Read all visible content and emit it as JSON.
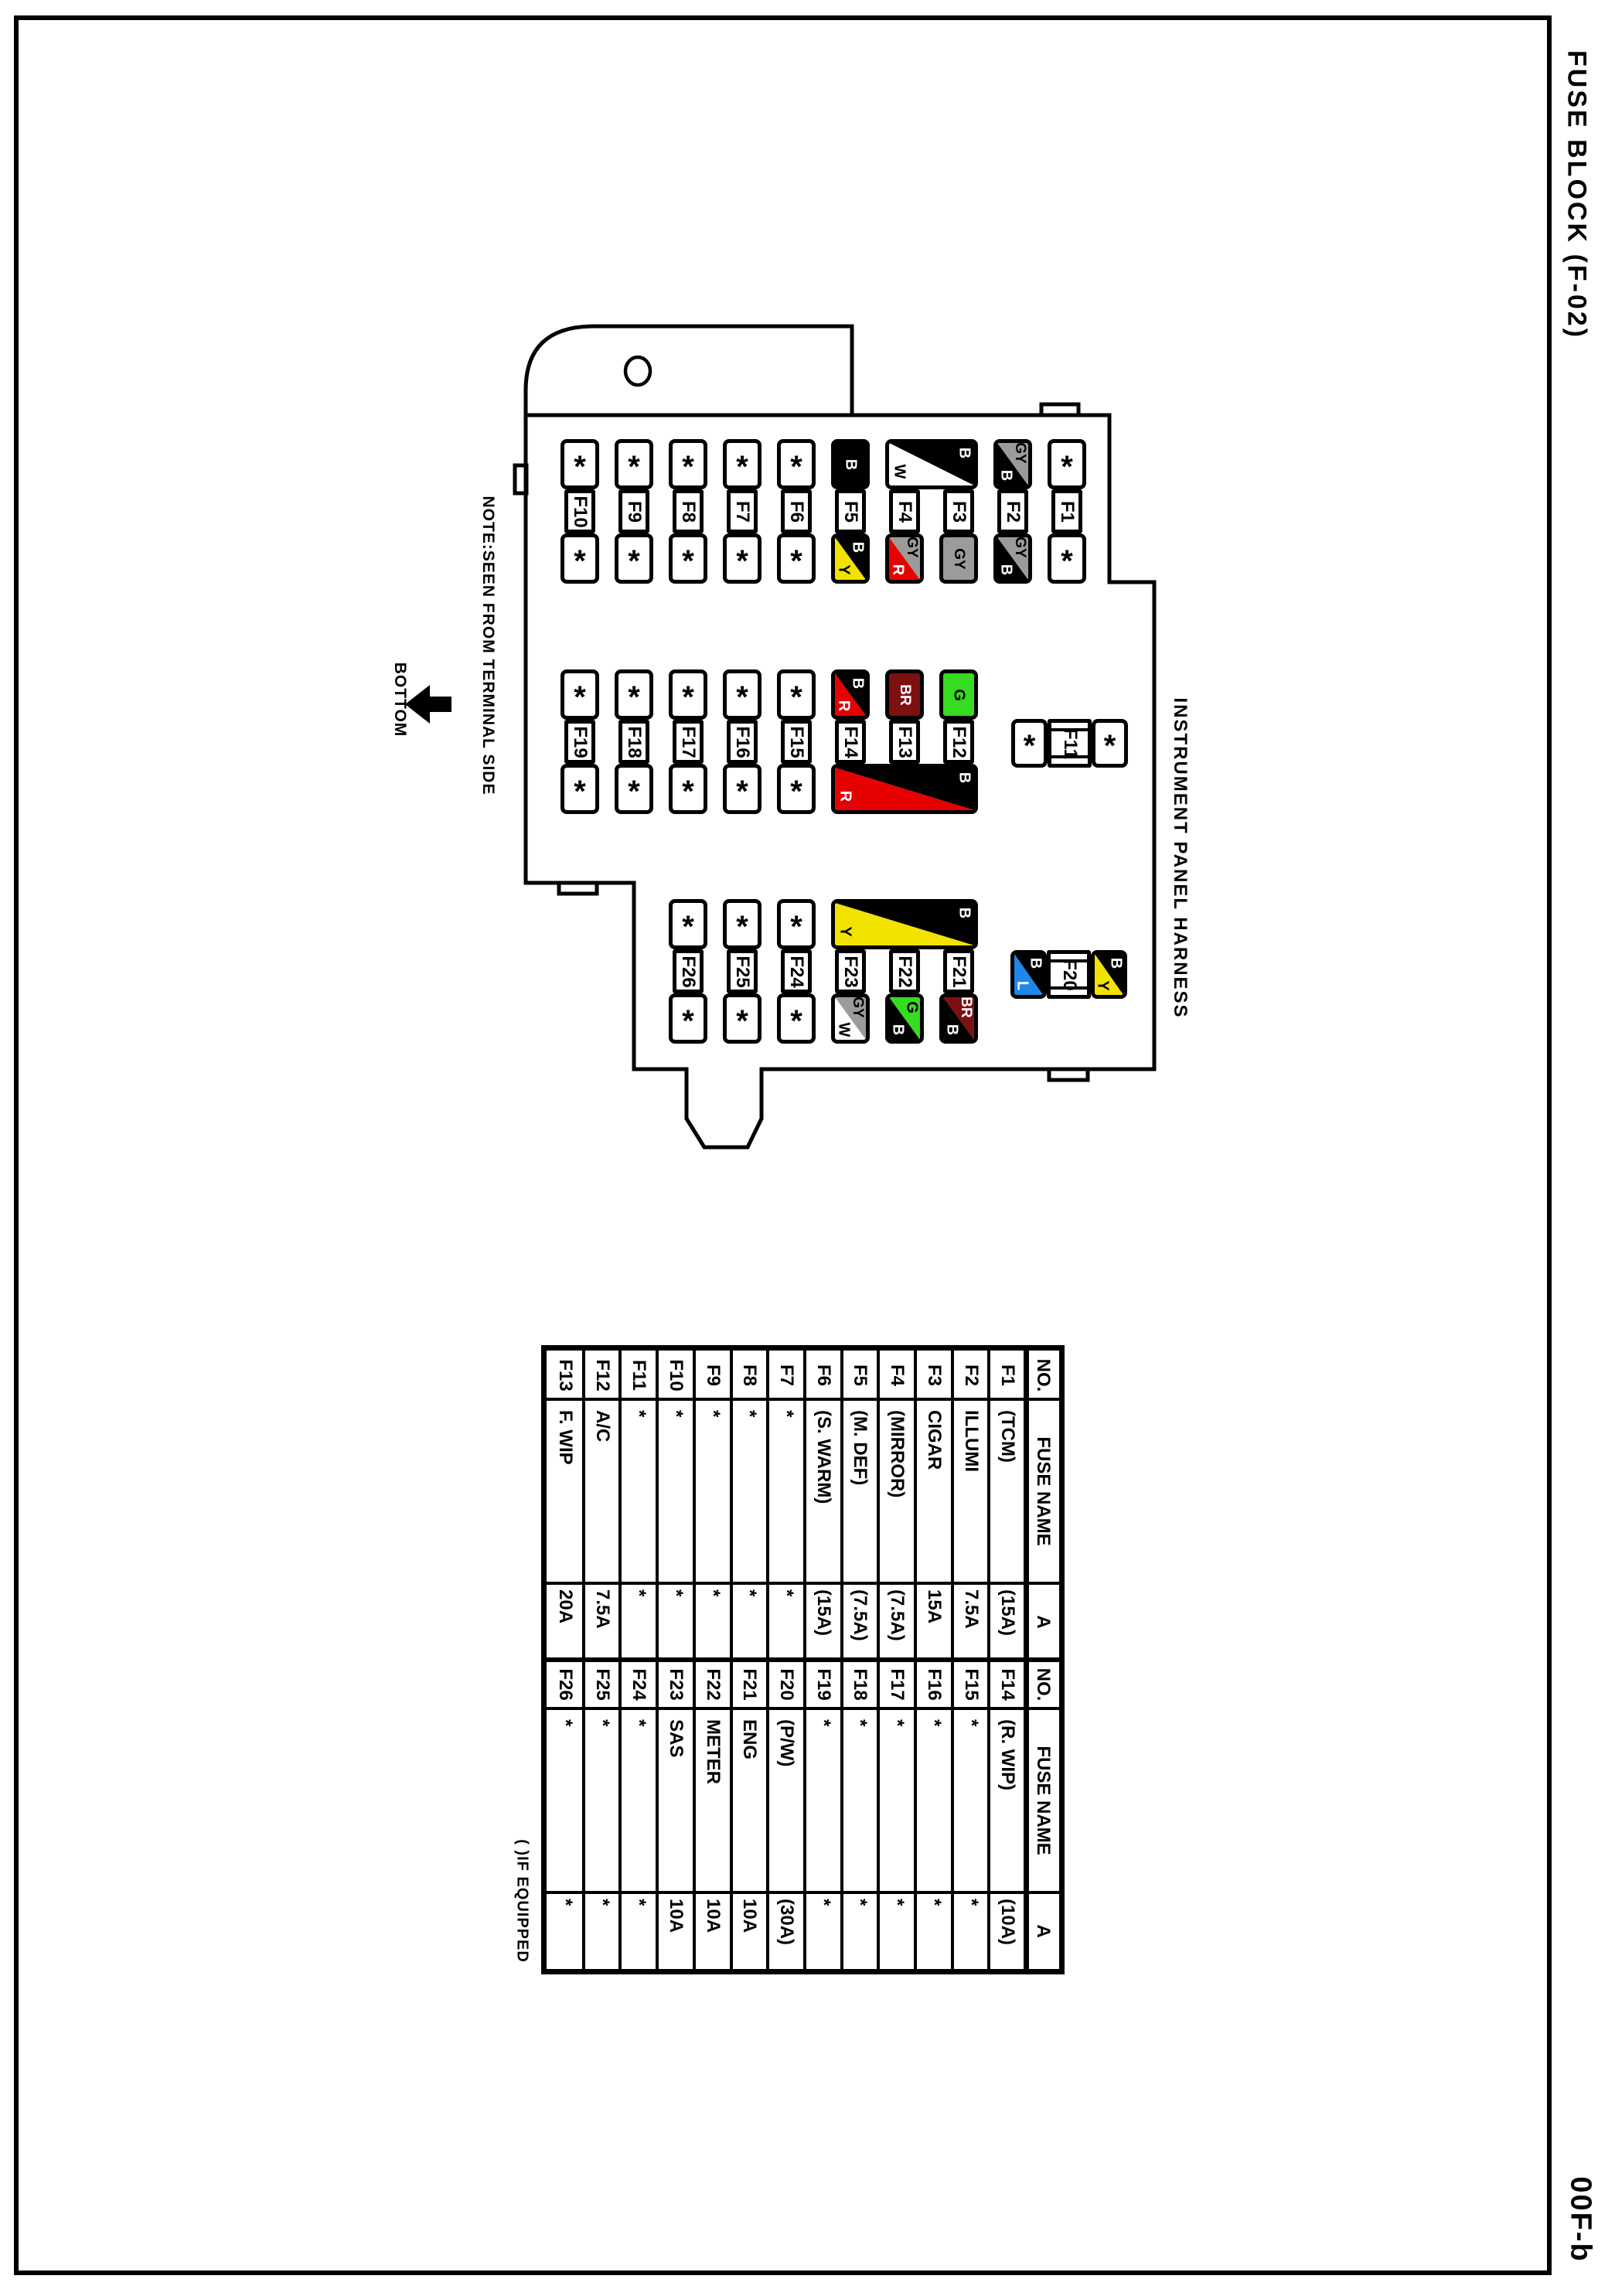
{
  "page": {
    "title": "FUSE BLOCK (F-02)",
    "page_code": "00F-b",
    "note": "NOTE:SEEN FROM TERMINAL SIDE",
    "bottom_label": "BOTTOM",
    "harness_label": "INSTRUMENT PANEL HARNESS",
    "if_equipped_note": "( )IF EQUIPPED"
  },
  "colors": {
    "B": "#000000",
    "W": "#ffffff",
    "GY": "#9b9b9b",
    "R": "#e60000",
    "Y": "#f2e200",
    "G": "#35dc1f",
    "BR": "#7d1011",
    "L": "#1f87e8"
  },
  "fuse_block": {
    "star_symbol": "*",
    "rows": [
      {
        "fuses": [
          {
            "label": "F10",
            "col": 0,
            "top": {
              "star": true
            },
            "bottom": {
              "star": true
            }
          },
          {
            "label": "F9",
            "col": 1,
            "top": {
              "star": true
            },
            "bottom": {
              "star": true
            }
          },
          {
            "label": "F8",
            "col": 2,
            "top": {
              "star": true
            },
            "bottom": {
              "star": true
            }
          },
          {
            "label": "F7",
            "col": 3,
            "top": {
              "star": true
            },
            "bottom": {
              "star": true
            }
          },
          {
            "label": "F6",
            "col": 4,
            "top": {
              "star": true
            },
            "bottom": {
              "star": true
            }
          },
          {
            "label": "F5",
            "col": 5,
            "top": {
              "solid": "B"
            },
            "bottom": {
              "diag": [
                "B",
                "Y"
              ]
            }
          },
          {
            "label": "F4",
            "col": 6,
            "bottom": {
              "diag": [
                "GY",
                "R"
              ]
            }
          },
          {
            "label": "F3",
            "col": 7,
            "bottom": {
              "solid": "GY"
            }
          },
          {
            "label": "F2",
            "col": 8,
            "top": {
              "diag": [
                "GY",
                "B"
              ]
            },
            "bottom": {
              "diag": [
                "GY",
                "B"
              ]
            }
          },
          {
            "label": "F1",
            "col": 9,
            "top": {
              "star": true
            },
            "bottom": {
              "star": true
            }
          }
        ],
        "wide_caps": [
          {
            "band": "top",
            "from_col": 6,
            "to_col": 7,
            "diag": [
              "B",
              "W"
            ]
          }
        ]
      },
      {
        "fuses": [
          {
            "label": "F19",
            "col": 0,
            "top": {
              "star": true
            },
            "bottom": {
              "star": true
            }
          },
          {
            "label": "F18",
            "col": 1,
            "top": {
              "star": true
            },
            "bottom": {
              "star": true
            }
          },
          {
            "label": "F17",
            "col": 2,
            "top": {
              "star": true
            },
            "bottom": {
              "star": true
            }
          },
          {
            "label": "F16",
            "col": 3,
            "top": {
              "star": true
            },
            "bottom": {
              "star": true
            }
          },
          {
            "label": "F15",
            "col": 4,
            "top": {
              "star": true
            },
            "bottom": {
              "star": true
            }
          },
          {
            "label": "F14",
            "col": 5,
            "top": {
              "diag": [
                "B",
                "R"
              ]
            }
          },
          {
            "label": "F13",
            "col": 6,
            "top": {
              "solid": "BR"
            }
          },
          {
            "label": "F12",
            "col": 7,
            "top": {
              "solid": "G"
            }
          }
        ],
        "wide_caps": [
          {
            "band": "bottom",
            "from_col": 5,
            "to_col": 7,
            "diag": [
              "B",
              "R"
            ]
          }
        ]
      },
      {
        "fuses": [
          {
            "label": "F26",
            "col": 2,
            "top": {
              "star": true
            },
            "bottom": {
              "star": true
            }
          },
          {
            "label": "F25",
            "col": 3,
            "top": {
              "star": true
            },
            "bottom": {
              "star": true
            }
          },
          {
            "label": "F24",
            "col": 4,
            "top": {
              "star": true
            },
            "bottom": {
              "star": true
            }
          },
          {
            "label": "F23",
            "col": 5,
            "bottom": {
              "diag": [
                "GY",
                "W"
              ]
            }
          },
          {
            "label": "F22",
            "col": 6,
            "bottom": {
              "diag": [
                "G",
                "B"
              ]
            }
          },
          {
            "label": "F21",
            "col": 7,
            "bottom": {
              "diag": [
                "BR",
                "B"
              ]
            }
          }
        ],
        "wide_caps": [
          {
            "band": "top",
            "from_col": 5,
            "to_col": 7,
            "diag": [
              "B",
              "Y"
            ]
          }
        ]
      }
    ],
    "inline_fuses": [
      {
        "label": "F11",
        "left": {
          "star": true
        },
        "right": {
          "star": true
        }
      },
      {
        "label": "F20",
        "left": {
          "diag": [
            "B",
            "L"
          ]
        },
        "right": {
          "diag": [
            "B",
            "Y"
          ]
        }
      }
    ]
  },
  "table": {
    "headers": {
      "no": "NO.",
      "name": "FUSE NAME",
      "amp": "A"
    },
    "rows_left": [
      {
        "no": "F1",
        "name": "(TCM)",
        "amp": "(15A)"
      },
      {
        "no": "F2",
        "name": "ILLUMI",
        "amp": "7.5A"
      },
      {
        "no": "F3",
        "name": "CIGAR",
        "amp": "15A"
      },
      {
        "no": "F4",
        "name": "(MIRROR)",
        "amp": "(7.5A)"
      },
      {
        "no": "F5",
        "name": "(M. DEF)",
        "amp": "(7.5A)"
      },
      {
        "no": "F6",
        "name": "(S. WARM)",
        "amp": "(15A)"
      },
      {
        "no": "F7",
        "name": "*",
        "amp": "*"
      },
      {
        "no": "F8",
        "name": "*",
        "amp": "*"
      },
      {
        "no": "F9",
        "name": "*",
        "amp": "*"
      },
      {
        "no": "F10",
        "name": "*",
        "amp": "*"
      },
      {
        "no": "F11",
        "name": "*",
        "amp": "*"
      },
      {
        "no": "F12",
        "name": "A/C",
        "amp": "7.5A"
      },
      {
        "no": "F13",
        "name": "F. WIP",
        "amp": "20A"
      }
    ],
    "rows_right": [
      {
        "no": "F14",
        "name": "(R. WIP)",
        "amp": "(10A)"
      },
      {
        "no": "F15",
        "name": "*",
        "amp": "*"
      },
      {
        "no": "F16",
        "name": "*",
        "amp": "*"
      },
      {
        "no": "F17",
        "name": "*",
        "amp": "*"
      },
      {
        "no": "F18",
        "name": "*",
        "amp": "*"
      },
      {
        "no": "F19",
        "name": "*",
        "amp": "*"
      },
      {
        "no": "F20",
        "name": "(P/W)",
        "amp": "(30A)"
      },
      {
        "no": "F21",
        "name": "ENG",
        "amp": "10A"
      },
      {
        "no": "F22",
        "name": "METER",
        "amp": "10A"
      },
      {
        "no": "F23",
        "name": "SAS",
        "amp": "10A"
      },
      {
        "no": "F24",
        "name": "*",
        "amp": "*"
      },
      {
        "no": "F25",
        "name": "*",
        "amp": "*"
      },
      {
        "no": "F26",
        "name": "*",
        "amp": "*"
      }
    ]
  }
}
